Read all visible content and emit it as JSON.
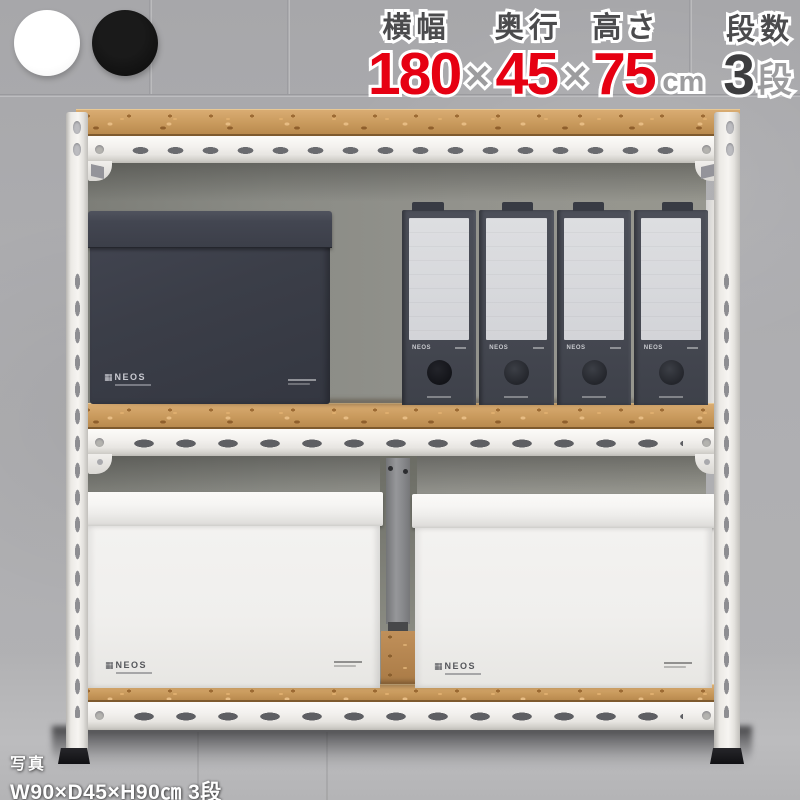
{
  "product_overlay": {
    "swatches": [
      {
        "name": "white",
        "color": "#ffffff"
      },
      {
        "name": "black",
        "color": "#0d0d0d"
      }
    ],
    "specs": {
      "separator": "×",
      "groups": [
        {
          "label": "横幅",
          "value": "180"
        },
        {
          "label": "奥行",
          "value": "45"
        },
        {
          "label": "高さ",
          "value": "75",
          "unit": "cm"
        },
        {
          "label": "段数",
          "value": "3",
          "unit": "段"
        }
      ],
      "accent_color": "#e60012",
      "label_color": "#4b4b4d",
      "muted_color": "#9c9c9e",
      "count_color": "#3d3d3f"
    },
    "caption": {
      "line1": "写真",
      "line2": "W90×D45×H90㎝ 3段"
    }
  },
  "photo": {
    "rack": {
      "tier_count": 3,
      "frame_color": "#f2f0ed",
      "wood_color": "#c99a5d"
    },
    "brand": {
      "icon": "▦",
      "name": "NEOS"
    },
    "items": {
      "black_box_count": 1,
      "file_box_count": 4,
      "white_box_count": 2
    }
  }
}
